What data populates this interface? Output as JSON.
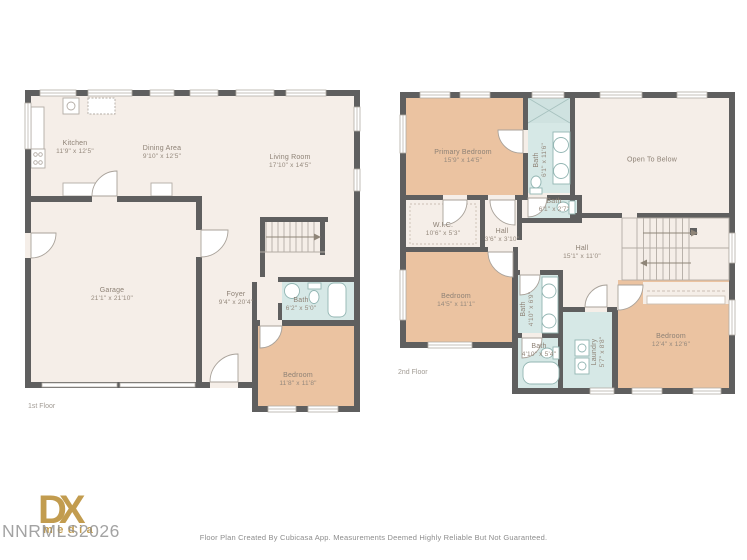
{
  "page": {
    "footer": "Floor Plan Created By Cubicasa App. Measurements Deemed Highly Reliable But Not Guaranteed.",
    "watermark": "NNRMLS2026",
    "logo_main": "DX",
    "logo_sub": "media"
  },
  "colors": {
    "floor_cream": "#f5eee8",
    "bedroom_peach": "#ebc3a1",
    "bath_blue": "#d6e8e6",
    "wall_gray": "#5f5f5f",
    "label_gray": "#8d8175",
    "logo_gold": "#c29c4f",
    "watermark_gray": "#8f8f8f"
  },
  "floor1": {
    "label": "1st Floor",
    "rooms": {
      "kitchen": {
        "name": "Kitchen",
        "dims": "11'9\" x 12'5\""
      },
      "dining": {
        "name": "Dining Area",
        "dims": "9'10\" x 12'5\""
      },
      "living": {
        "name": "Living Room",
        "dims": "17'10\" x 14'5\""
      },
      "garage": {
        "name": "Garage",
        "dims": "21'1\" x 21'10\""
      },
      "foyer": {
        "name": "Foyer",
        "dims": "9'4\" x 20'4\""
      },
      "bath": {
        "name": "Bath",
        "dims": "6'2\" x 5'0\""
      },
      "bedroom": {
        "name": "Bedroom",
        "dims": "11'8\" x 11'8\""
      }
    }
  },
  "floor2": {
    "label": "2nd Floor",
    "rooms": {
      "primary": {
        "name": "Primary Bedroom",
        "dims": "15'9\" x 14'5\""
      },
      "bath_main": {
        "name": "Bath",
        "dims": "6'1\" x 11'6\""
      },
      "open_below": {
        "name": "Open To Below"
      },
      "wic": {
        "name": "W.I.C.",
        "dims": "10'6\" x 5'3\""
      },
      "hall_small": {
        "name": "Hall",
        "dims": "3'6\" x 3'10\""
      },
      "bath_small": {
        "name": "Bath",
        "dims": "6'1\" x 2'7\""
      },
      "hall": {
        "name": "Hall",
        "dims": "15'1\" x 11'0\""
      },
      "bedroom_left": {
        "name": "Bedroom",
        "dims": "14'5\" x 11'1\""
      },
      "bath_mid": {
        "name": "Bath",
        "dims": "4'10\" x 6'9\""
      },
      "bath_tub": {
        "name": "Bath",
        "dims": "4'10\" x 5'4\""
      },
      "laundry": {
        "name": "Laundry",
        "dims": "5'7\" x 8'8\""
      },
      "bedroom_right": {
        "name": "Bedroom",
        "dims": "12'4\" x 12'6\""
      }
    }
  }
}
